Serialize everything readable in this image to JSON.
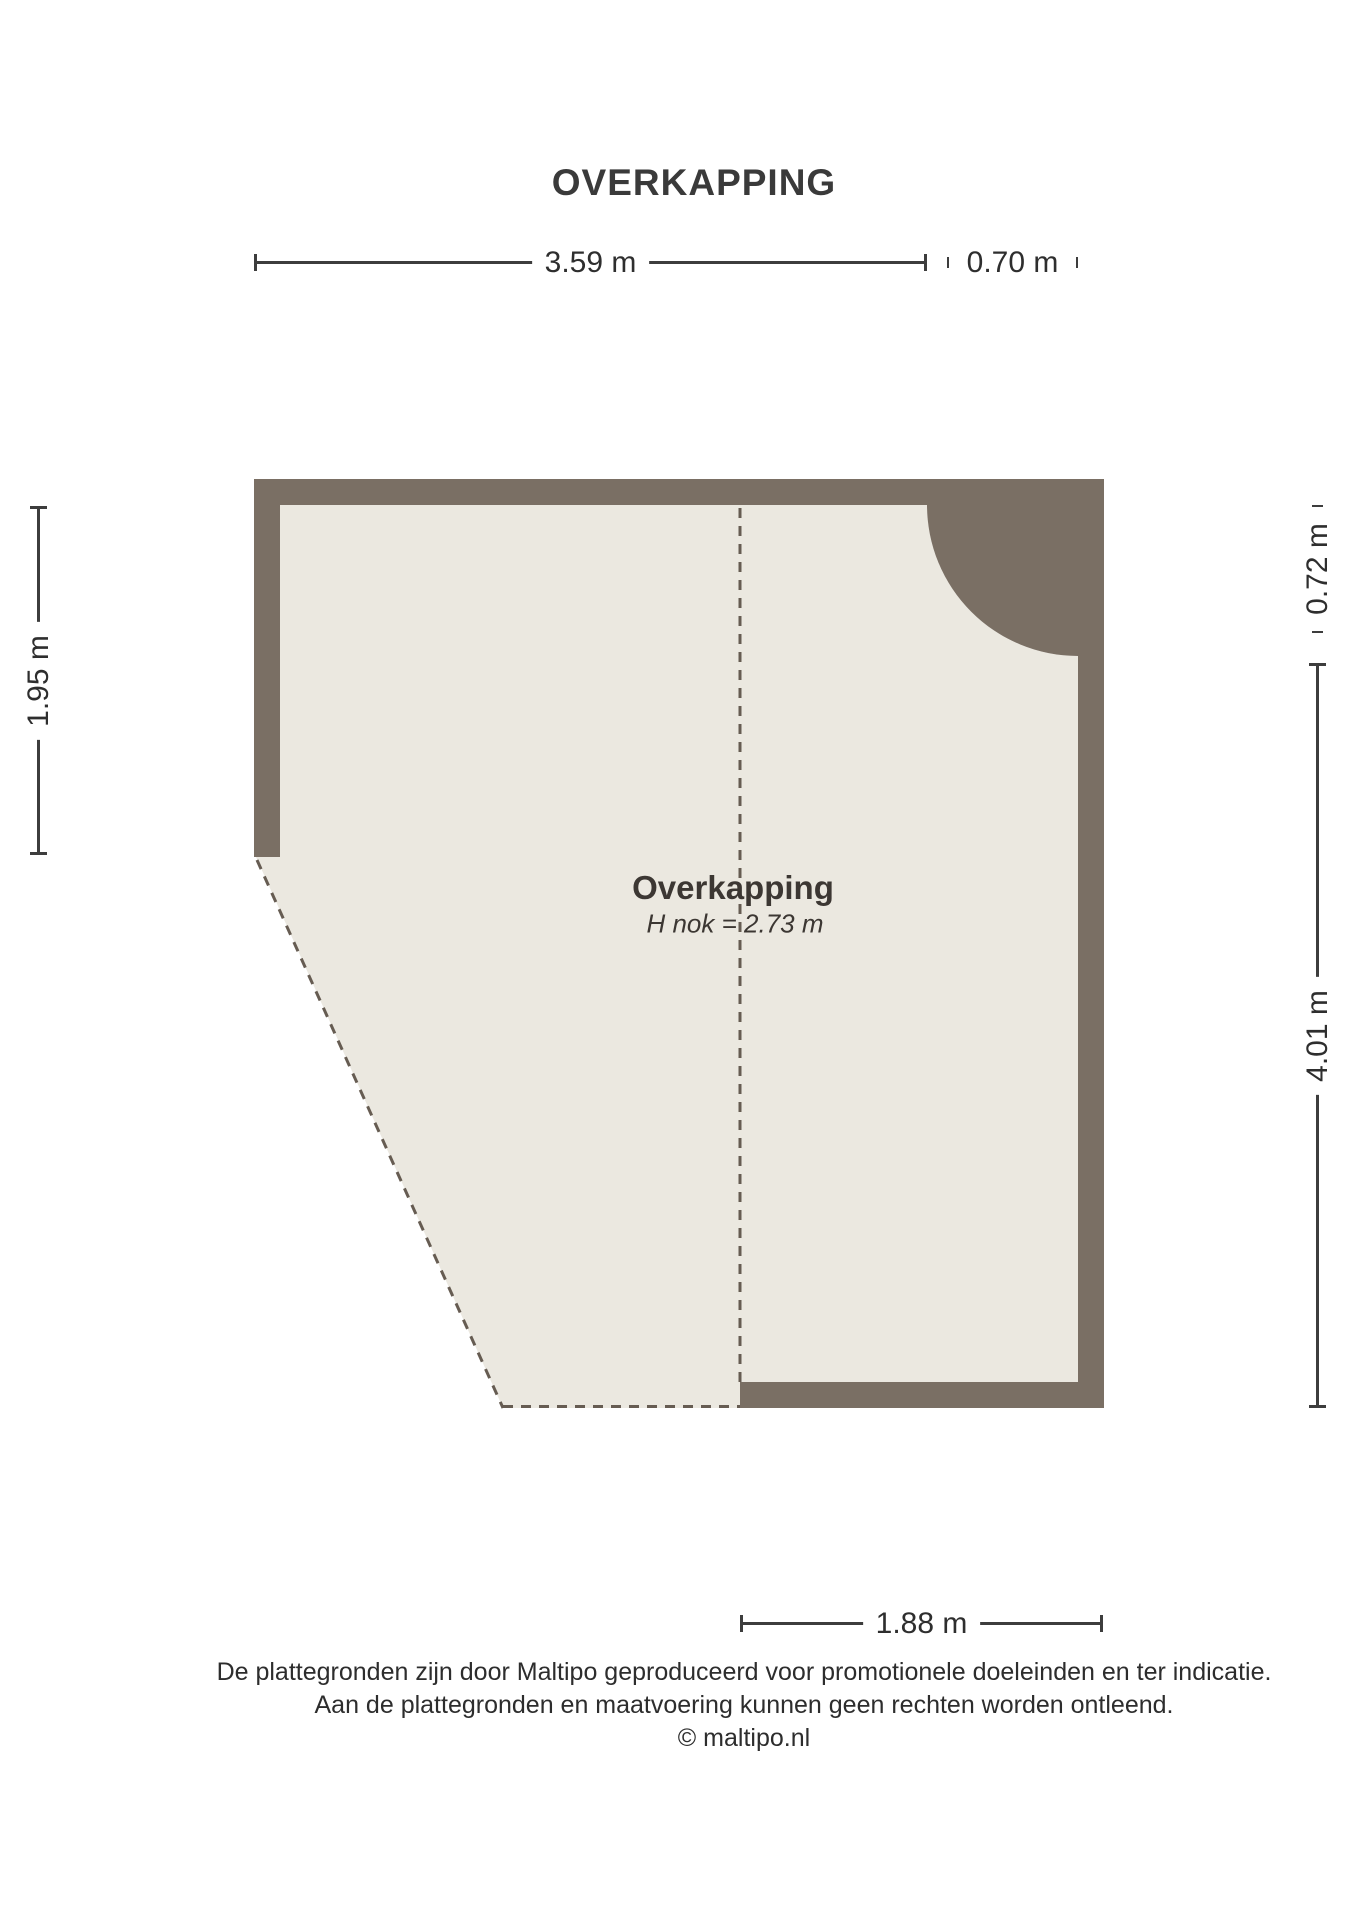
{
  "page_title": "OVERKAPPING",
  "plan": {
    "room_label": "Overkapping",
    "room_sublabel": "H nok = 2.73 m"
  },
  "dimensions": {
    "top": "3.59 m",
    "top_right": "0.70 m",
    "left": "1.95 m",
    "right_top": "0.72 m",
    "right": "4.01 m",
    "bottom": "1.88 m"
  },
  "footer": {
    "line1": "De plattegronden zijn door Maltipo geproduceerd voor promotionele doeleinden en ter indicatie.",
    "line2": "Aan de plattegronden en maatvoering kunnen geen rechten worden ontleend.",
    "line3": "© maltipo.nl"
  },
  "colors": {
    "wall": "#7a6f64",
    "floor": "#ebe8e0",
    "dashed_line": "#665c52",
    "dimension_line": "#3d3d3d",
    "text": "#2e2e2e"
  }
}
